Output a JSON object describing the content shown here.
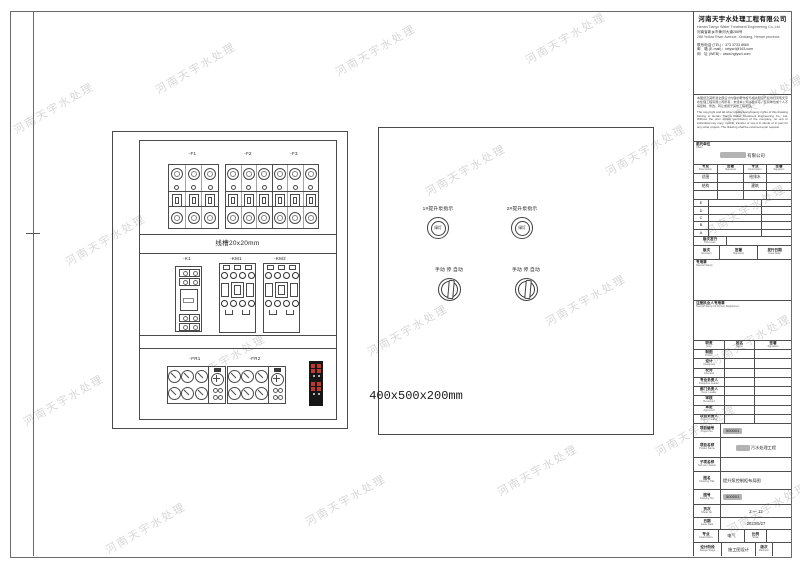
{
  "watermark": {
    "text": "河南天宇水处理",
    "positions": [
      [
        8,
        100
      ],
      [
        150,
        60
      ],
      [
        330,
        42
      ],
      [
        520,
        30
      ],
      [
        60,
        232
      ],
      [
        230,
        192
      ],
      [
        420,
        162
      ],
      [
        600,
        142
      ],
      [
        18,
        392
      ],
      [
        180,
        352
      ],
      [
        362,
        322
      ],
      [
        540,
        292
      ],
      [
        100,
        520
      ],
      [
        300,
        492
      ],
      [
        492,
        462
      ],
      [
        650,
        422
      ],
      [
        700,
        202
      ],
      [
        718,
        92
      ],
      [
        705,
        332
      ],
      [
        722,
        500
      ]
    ]
  },
  "drawing": {
    "breaker_labels": [
      "-F1",
      "-F2",
      "-F3"
    ],
    "duct_label": "线槽20x20mm",
    "relay_label": "-K1",
    "contactor_labels": [
      "-KM1",
      "-KM2"
    ],
    "thermal_labels": [
      "-FR1",
      "-FR2"
    ],
    "lights": [
      {
        "label": "1#提升泵指示",
        "lens": "绿灯"
      },
      {
        "label": "2#提升泵指示",
        "lens": "绿灯"
      }
    ],
    "switch_label": "手动 停 自动",
    "enclosure_size": "400x500x200mm"
  },
  "title_block": {
    "company": {
      "name": "河南天宇水处理工程有限公司",
      "name_en": "Henan Tianyu Water Treatment Engineering Co.,Ltd.",
      "address_cn": "河南省新乡市黄河大道288号",
      "address_en": "288 Yellow River Avenue, Xinxiang, Henan province",
      "tel": "联系电话 (TEL)：373 3733 8660",
      "email": "邮　箱 (E-mail)：xxtyscl@163.com",
      "web": "网　址 (WEB)：www.hgtyscl.com"
    },
    "notice": {
      "cn": "本图纸及其所载全部设计内容的著作权与相关知识产权均归河南天宇水处理工程有限公司所有，未经本公司书面许可，任何单位或个人不得复制、修改、转让或用于其他工程项目。",
      "en": "The copyright and all other intellectual property rights of this drawing belong to Henan Tianyu Water Treatment Engineering Co., Ltd. Without the prior written permission of the company, no unit or individual may copy, modify, transfer or use it in whole or in part for any other project. The drawing shall be returned upon request."
    },
    "client": {
      "label_cn": "委托单位",
      "label_en": "Client",
      "value": "有限公司"
    },
    "sig": {
      "header": [
        {
          "cn": "专业",
          "en": "Description"
        },
        {
          "cn": "签署",
          "en": "Signature"
        },
        {
          "cn": "专业",
          "en": "Description"
        },
        {
          "cn": "签署",
          "en": "Signature"
        }
      ],
      "rows": [
        [
          "总图",
          "",
          "给排水",
          ""
        ],
        [
          "结构",
          "",
          "建筑",
          ""
        ],
        [
          "",
          "",
          "",
          ""
        ]
      ]
    },
    "revision": {
      "letters": [
        "E",
        "D",
        "C",
        "B",
        "A"
      ],
      "issue_label": {
        "cn": "版次发行",
        "en": "Plot Issue"
      },
      "header": [
        {
          "cn": "版次",
          "en": "Revision"
        },
        {
          "cn": "签署",
          "en": "Signature"
        },
        {
          "cn": "发行日期",
          "en": "Issue Date"
        }
      ]
    },
    "stamps": {
      "special": {
        "cn": "专用章",
        "en": "Special Stamp"
      },
      "registered": {
        "cn": "注册执业人专用章",
        "en": "Special Stamp Of Person Registered"
      }
    },
    "staff": {
      "header": [
        {
          "cn": "职责",
          "en": "Duty"
        },
        {
          "cn": "姓名",
          "en": "Name"
        },
        {
          "cn": "签署",
          "en": "Signature"
        }
      ],
      "rows": [
        {
          "cn": "制图",
          "en": "Drawn"
        },
        {
          "cn": "设计",
          "en": "Designed"
        },
        {
          "cn": "校对",
          "en": "Checked"
        },
        {
          "cn": "专业负责人",
          "en": "Discipline Leader"
        },
        {
          "cn": "部门负责人",
          "en": "Dept. Leader"
        },
        {
          "cn": "审核",
          "en": "Reviewed"
        },
        {
          "cn": "审定",
          "en": "Approved"
        },
        {
          "cn": "项目负责人",
          "en": "Project Leader"
        }
      ]
    },
    "project": {
      "no_label": {
        "cn": "项目编号",
        "en": "Project No."
      },
      "no_value": "500001",
      "name_label": {
        "cn": "项目名称",
        "en": "Project Name"
      },
      "name_value": "污水处理工程",
      "subitem_label": {
        "cn": "子项名称",
        "en": "Sub-item Name"
      },
      "subitem_value": "",
      "title_label": {
        "cn": "图名",
        "en": "Drawing Title"
      },
      "title_value": "提升泵控制柜布局图",
      "dwgno_label": {
        "cn": "图号",
        "en": "Drawing No."
      },
      "dwgno_value": "500001",
      "sheet_label": {
        "cn": "页次",
        "en": "Sheet No."
      },
      "sheet_value": "2 — 12",
      "date_label": {
        "cn": "日期",
        "en": "Issue Date"
      },
      "date_value": "2023/5/27",
      "major_label": {
        "cn": "专业",
        "en": "Description"
      },
      "major_value": "电气",
      "scale_label": {
        "cn": "比例",
        "en": "Scale"
      },
      "scale_value": "",
      "stage_label": {
        "cn": "设计阶段",
        "en": "Design Stage"
      },
      "stage_value": "施工图设计",
      "rev_label": {
        "cn": "版次",
        "en": "Revision"
      },
      "rev_value": ""
    }
  }
}
